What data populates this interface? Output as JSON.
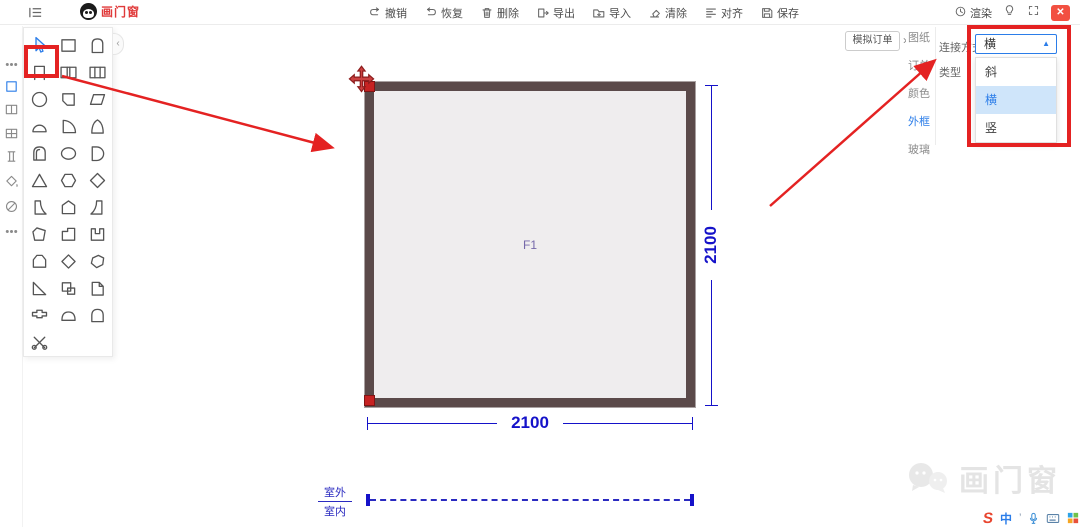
{
  "colors": {
    "accent": "#2b7de9",
    "annotation_red": "#e42222",
    "dimension_blue": "#1512c9",
    "frame_brown": "#5b4a4a",
    "logo_red": "#e03a3a"
  },
  "topbar": {
    "logo_text": "画门窗",
    "toolbar": [
      {
        "name": "undo",
        "label": "撤销"
      },
      {
        "name": "redo",
        "label": "恢复"
      },
      {
        "name": "delete",
        "label": "删除"
      },
      {
        "name": "export",
        "label": "导出"
      },
      {
        "name": "import",
        "label": "导入"
      },
      {
        "name": "clear",
        "label": "清除"
      },
      {
        "name": "align",
        "label": "对齐"
      },
      {
        "name": "save",
        "label": "保存"
      }
    ],
    "render_label": "渲染",
    "close_glyph": "✕"
  },
  "left_rail": {
    "items": [
      {
        "name": "more-tools-top"
      },
      {
        "name": "rect-category",
        "active": true
      },
      {
        "name": "two-pane-category"
      },
      {
        "name": "four-pane-category"
      },
      {
        "name": "beam-category"
      },
      {
        "name": "fill-category"
      },
      {
        "name": "disabled-category"
      },
      {
        "name": "more-tools-bottom"
      }
    ]
  },
  "palette": {
    "collapse_glyph": "‹",
    "cells": [
      {
        "name": "select-cursor",
        "active": true
      },
      {
        "name": "rect"
      },
      {
        "name": "arch-door"
      },
      {
        "name": "top-open-frame",
        "highlighted": true
      },
      {
        "name": "double-pane"
      },
      {
        "name": "triple-pane"
      },
      {
        "name": "circle"
      },
      {
        "name": "notched-rect"
      },
      {
        "name": "parallelogram"
      },
      {
        "name": "semicircle"
      },
      {
        "name": "quarter-circle"
      },
      {
        "name": "pointed-arch"
      },
      {
        "name": "round-top-door"
      },
      {
        "name": "ellipse"
      },
      {
        "name": "half-round-right"
      },
      {
        "name": "triangle"
      },
      {
        "name": "hexagon"
      },
      {
        "name": "diamond"
      },
      {
        "name": "quarter-pane-left"
      },
      {
        "name": "pentagon"
      },
      {
        "name": "quarter-pane-right"
      },
      {
        "name": "irregular-pentagon"
      },
      {
        "name": "step-rect"
      },
      {
        "name": "u-bracket"
      },
      {
        "name": "flat-house"
      },
      {
        "name": "soft-diamond"
      },
      {
        "name": "free-polygon"
      },
      {
        "name": "right-triangle"
      },
      {
        "name": "corner-squares"
      },
      {
        "name": "folded-page"
      },
      {
        "name": "t-bracket"
      },
      {
        "name": "low-dome"
      },
      {
        "name": "dome-arch"
      },
      {
        "name": "scissors"
      }
    ]
  },
  "canvas": {
    "frame_label": "F1",
    "width_dim": "2100",
    "height_dim": "2100",
    "outside_label": "室外",
    "inside_label": "室内"
  },
  "right_panel": {
    "order_button": "模拟订单",
    "chevron": "›",
    "tabs": [
      {
        "name": "drawing",
        "label": "图纸"
      },
      {
        "name": "order",
        "label": "订单"
      },
      {
        "name": "color",
        "label": "颜色"
      },
      {
        "name": "outer-frame",
        "label": "外框",
        "active": true
      },
      {
        "name": "glass",
        "label": "玻璃"
      }
    ],
    "connect_label": "连接方式",
    "type_label": "类型",
    "dropdown_value": "横",
    "dropdown_caret": "▲",
    "options": [
      {
        "name": "slant",
        "label": "斜"
      },
      {
        "name": "horizontal",
        "label": "横",
        "selected": true
      },
      {
        "name": "vertical",
        "label": "竖"
      }
    ]
  },
  "watermark": {
    "text": "画门窗"
  },
  "ime": {
    "logo": "S",
    "mode": "中",
    "apostrophe": "’"
  }
}
